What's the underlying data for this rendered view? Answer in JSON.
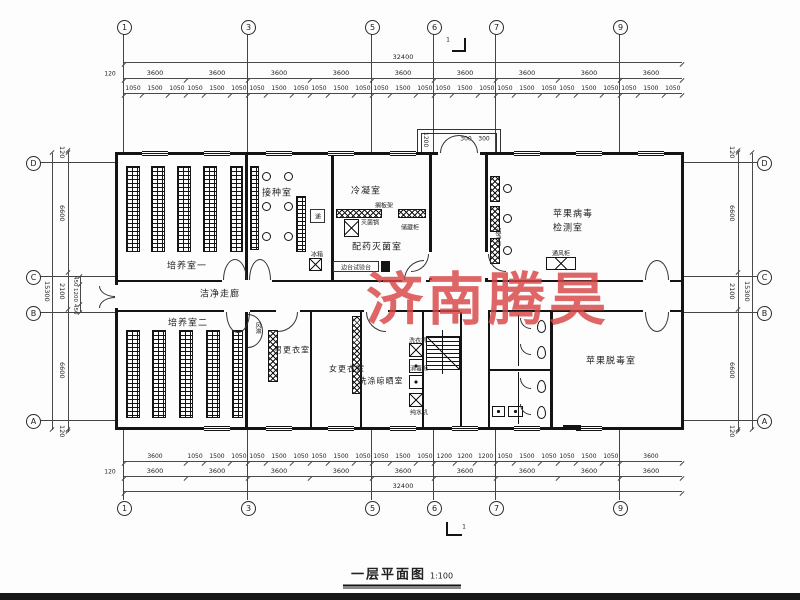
{
  "watermark": {
    "text": "济南腾昊",
    "color": "#d84545"
  },
  "title_block": {
    "title": "一层平面图",
    "scale": "1:100"
  },
  "axes": {
    "top": [
      "1",
      "3",
      "5",
      "6",
      "7",
      "9"
    ],
    "bottom": [
      "1",
      "3",
      "5",
      "6",
      "7",
      "9"
    ],
    "left": [
      "D",
      "C",
      "B",
      "A"
    ],
    "right": [
      "D",
      "C",
      "B",
      "A"
    ]
  },
  "dimensions": {
    "overall_width": "32400",
    "overall_height": "15300",
    "offset": "120",
    "top_bays": [
      "3600",
      "3600",
      "3600",
      "3600",
      "3600",
      "3600",
      "3600",
      "3600",
      "3600"
    ],
    "top_windows": [
      "1050",
      "1500",
      "1050",
      "1050",
      "1500",
      "1050",
      "1050",
      "1500",
      "1050",
      "1050",
      "1500",
      "1050",
      "1050",
      "1500",
      "1050",
      "1050",
      "1500",
      "1050",
      "1050",
      "1500",
      "1050",
      "1050",
      "1500",
      "1050",
      "1050",
      "1500",
      "1050"
    ],
    "bottom_windows": [
      "3600",
      "1050",
      "1500",
      "1050",
      "1050",
      "1500",
      "1050",
      "1050",
      "1500",
      "1050",
      "1050",
      "1500",
      "1050",
      "1200",
      "1200",
      "1200",
      "1050",
      "1500",
      "1050",
      "1050",
      "1500",
      "1050",
      "3600"
    ],
    "bottom_bays": [
      "3600",
      "3600",
      "3600",
      "3600",
      "3600",
      "3600",
      "3600",
      "3600",
      "3600"
    ],
    "left_main": [
      "120",
      "6600",
      "2100",
      "6600",
      "120"
    ],
    "right_main": [
      "120",
      "6600",
      "2100",
      "6600",
      "120"
    ],
    "left_inner": [
      "450",
      "1200",
      "450"
    ],
    "entrance_depth": "1200",
    "entrance_w1": "300",
    "entrance_w2": "300",
    "section_mark": "1"
  },
  "rooms": {
    "culture1": "培养室一",
    "inoculation": "接种室",
    "condensation": "冷凝室",
    "dispensing": "配药灭菌室",
    "virus_test_line1": "苹果病毒",
    "virus_test_line2": "检测室",
    "corridor": "洁净走廊",
    "culture2": "培养室二",
    "men_change": "男更衣室",
    "women_change": "女更衣室",
    "washing": "洗涤晾晒室",
    "detox": "苹果脱毒室"
  },
  "equipment": {
    "shelf_rack": "搁板架",
    "sterilizer": "灭菌锅",
    "storage_cabinet": "储藏柜",
    "side_bench": "边台试验台",
    "clean_bench": "超净台",
    "fume_hood": "通风柜",
    "fridge": "冰箱",
    "air_shower": "风淋",
    "pass_window": "递",
    "washer": "洗衣机",
    "disinfect_cabinet": "消毒柜",
    "water_machine": "纯水机"
  }
}
